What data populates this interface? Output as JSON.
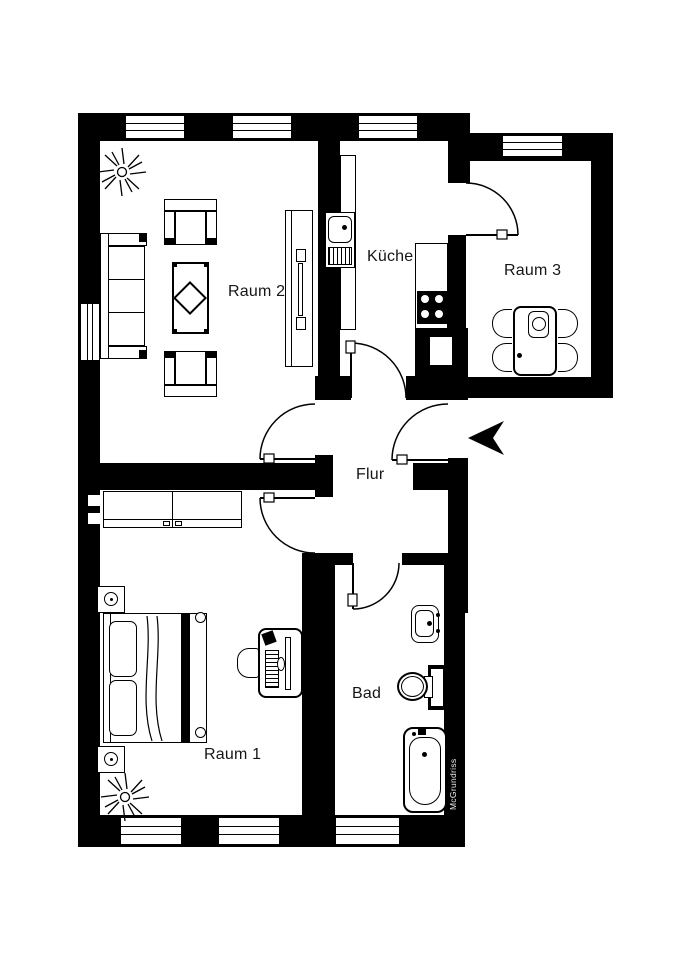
{
  "floorplan": {
    "rooms": [
      {
        "name": "Raum 2"
      },
      {
        "name": "Küche"
      },
      {
        "name": "Raum 3"
      },
      {
        "name": "Flur"
      },
      {
        "name": "Raum 1"
      },
      {
        "name": "Bad"
      }
    ],
    "watermark": "McGrundriss",
    "colors": {
      "wall": "#000000",
      "floor": "#ffffff",
      "label": "#161616",
      "watermark_text": "#efefef"
    }
  }
}
